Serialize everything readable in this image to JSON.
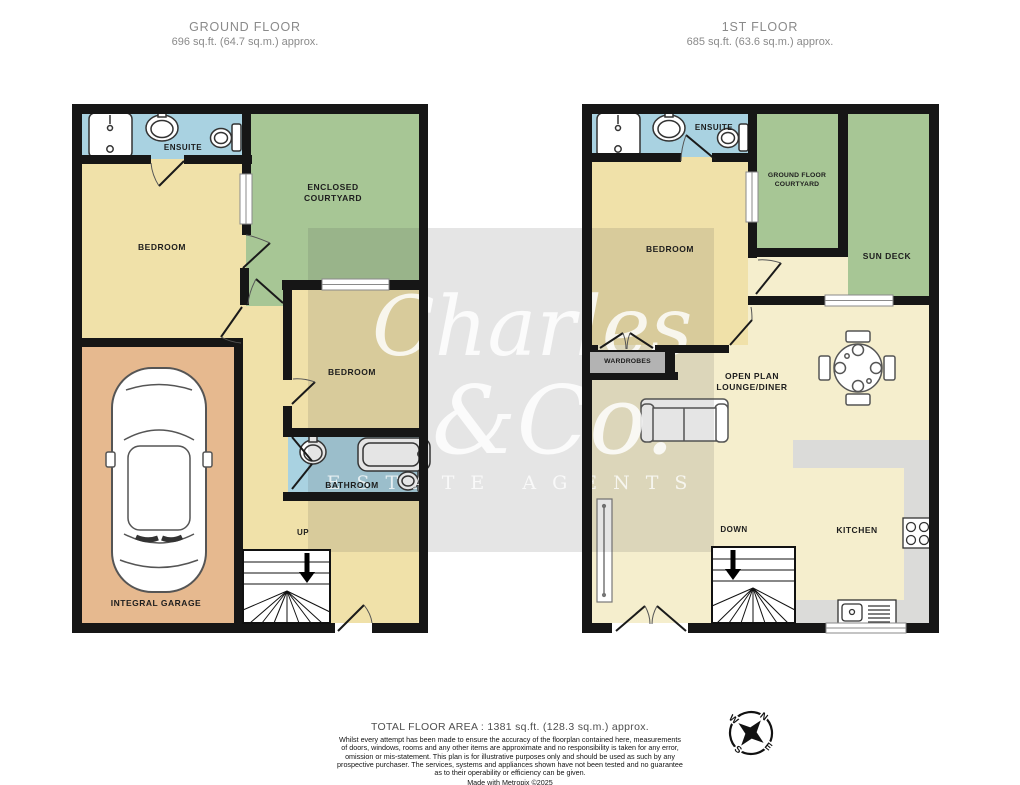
{
  "ground_floor": {
    "title": "GROUND FLOOR",
    "area": "696 sq.ft. (64.7 sq.m.) approx.",
    "rooms": {
      "ensuite": "ENSUITE",
      "courtyard": "ENCLOSED\nCOURTYARD",
      "bedroom_left": "BEDROOM",
      "bedroom_middle": "BEDROOM",
      "bathroom": "BATHROOM",
      "garage": "INTEGRAL GARAGE",
      "stairs": "UP"
    }
  },
  "first_floor": {
    "title": "1ST FLOOR",
    "area": "685 sq.ft. (63.6 sq.m.) approx.",
    "rooms": {
      "ensuite": "ENSUITE",
      "courtyard": "GROUND FLOOR\nCOURTYARD",
      "sun_deck": "SUN DECK",
      "bedroom": "BEDROOM",
      "wardrobes": "WARDROBES",
      "lounge": "OPEN PLAN\nLOUNGE/DINER",
      "kitchen": "KITCHEN",
      "stairs": "DOWN"
    }
  },
  "watermark": {
    "name_line1": "Charles",
    "name_line2": "&Co.",
    "tagline": "ESTATE AGENTS"
  },
  "footer": {
    "total_area": "TOTAL FLOOR AREA : 1381 sq.ft. (128.3 sq.m.) approx.",
    "disclaimer": "Whilst every attempt has been made to ensure the accuracy of the floorplan contained here, measurements\nof doors, windows, rooms and any other items are approximate and no responsibility is taken for any error,\nomission or mis-statement. This plan is for illustrative purposes only and should be used as such by any\nprospective purchaser. The services, systems and appliances shown have not been tested and no guarantee\nas to their operability or efficiency can be given.",
    "credit": "Made with Metropix ©2025"
  },
  "compass": {
    "north": "N",
    "east": "E",
    "south": "S",
    "west": "W"
  },
  "colors": {
    "wall": "#161616",
    "room_cream": "#f0e1a9",
    "room_pale": "#f5eecd",
    "outdoor_green": "#a7c695",
    "wet_room_blue": "#a9d2e1",
    "garage_orange": "#e6b98f",
    "kitchen_grey": "#dbdbd9"
  }
}
